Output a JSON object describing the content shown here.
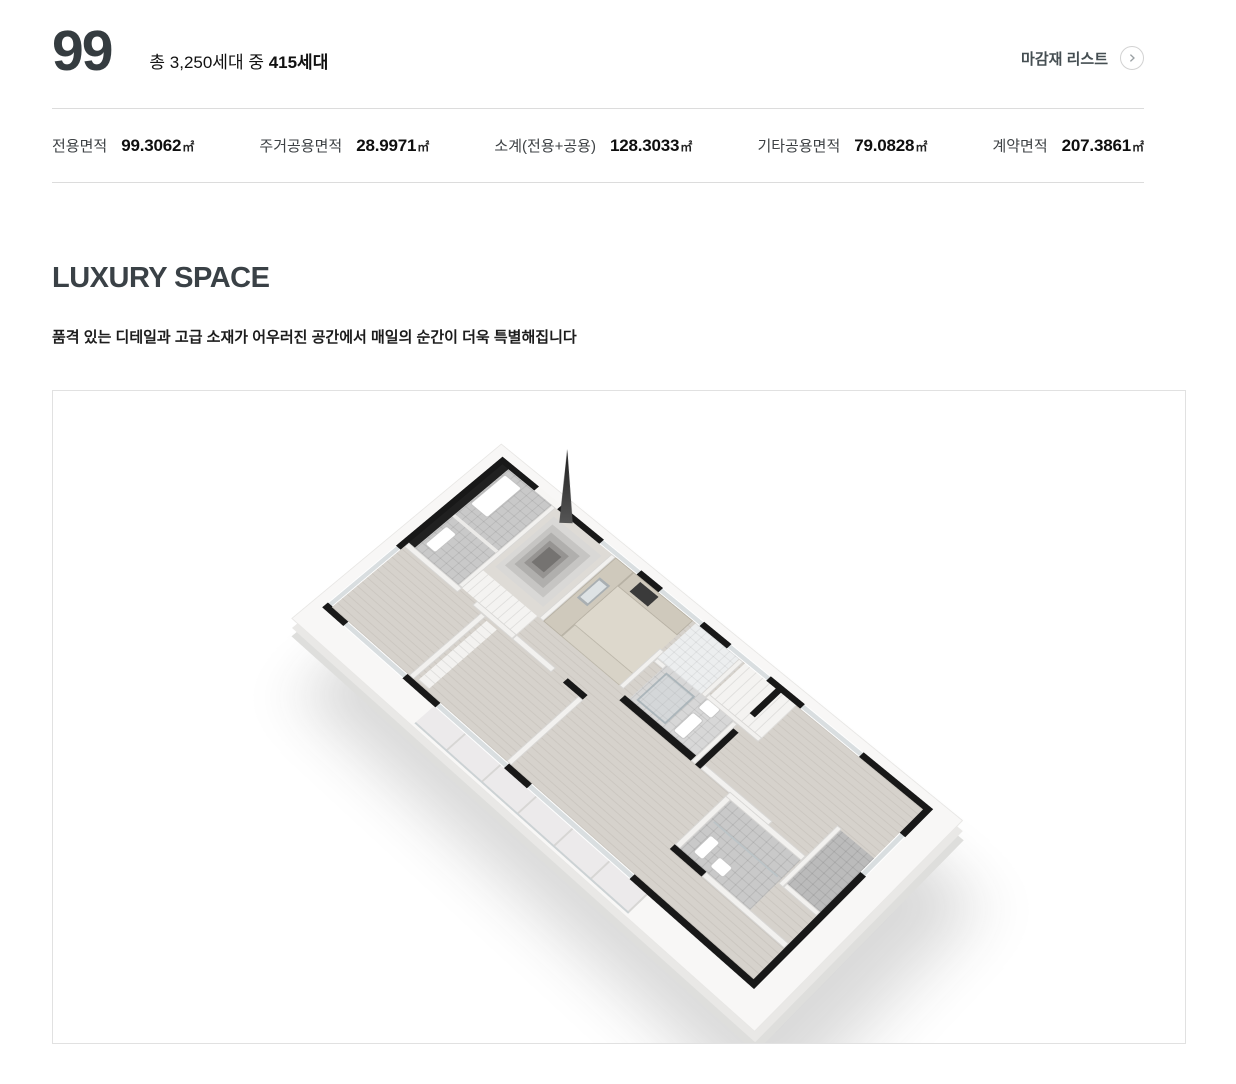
{
  "header": {
    "unit_type": "99",
    "total_prefix": "총 3,250세대 중 ",
    "total_bold": "415세대",
    "finish_list_label": "마감재 리스트"
  },
  "areas": {
    "items": [
      {
        "label": "전용면적",
        "value": "99.3062",
        "unit": "㎡"
      },
      {
        "label": "주거공용면적",
        "value": "28.9971",
        "unit": "㎡"
      },
      {
        "label": "소계(전용+공용)",
        "value": "128.3033",
        "unit": "㎡"
      },
      {
        "label": "기타공용면적",
        "value": "79.0828",
        "unit": "㎡"
      },
      {
        "label": "계약면적",
        "value": "207.3861",
        "unit": "㎡"
      }
    ]
  },
  "luxury": {
    "title": "LUXURY SPACE",
    "description": "품격 있는 디테일과 고급 소재가 어우러진 공간에서 매일의 순간이 더욱 특별해집니다"
  },
  "colors": {
    "text_primary": "#353c40",
    "divider": "#dcdcdc",
    "panel_border": "#e1e1e1",
    "wall_black": "#181818",
    "floor_wood": "#d6d2cc",
    "counter_beige": "#cfc9bc"
  }
}
